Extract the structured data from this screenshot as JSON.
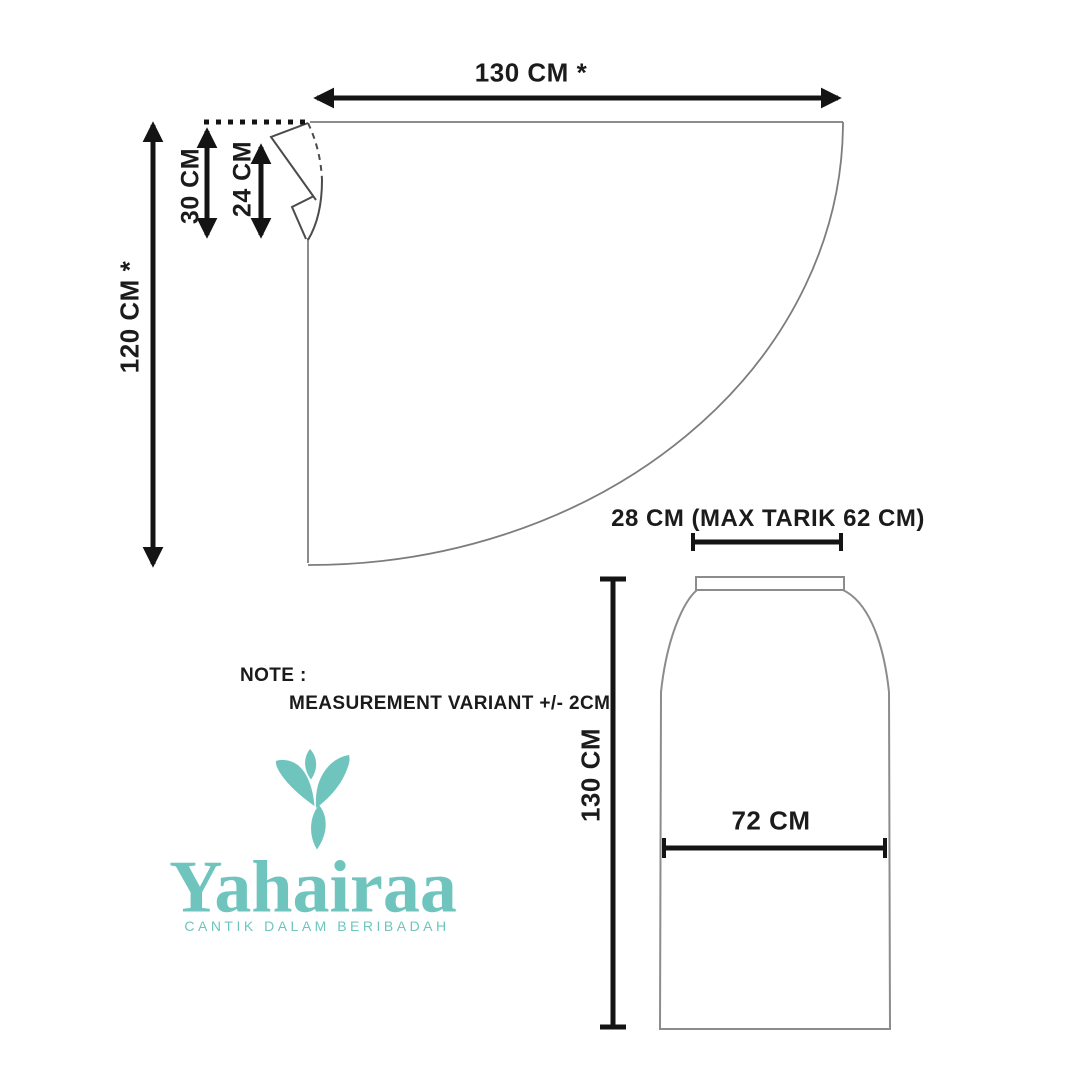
{
  "canvas": {
    "background": "#ffffff",
    "pattern_outline_color": "#8c8c8c",
    "dart_line_color": "#4b4b4b",
    "measure_color": "#141414"
  },
  "khimar": {
    "width_label": "130 CM *",
    "height_label": "120 CM *",
    "back_neck_label": "30 CM",
    "face_opening_label": "24 CM"
  },
  "skirt": {
    "waist_label": "28 CM (MAX TARIK 62 CM)",
    "length_label": "130 CM",
    "width_label": "72 CM"
  },
  "note": {
    "title": "NOTE :",
    "body": "MEASUREMENT VARIANT +/- 2CM"
  },
  "brand": {
    "name": "Yahairaa",
    "tagline": "CANTIK DALAM BERIBADAH",
    "color": "#6fc5bd"
  }
}
